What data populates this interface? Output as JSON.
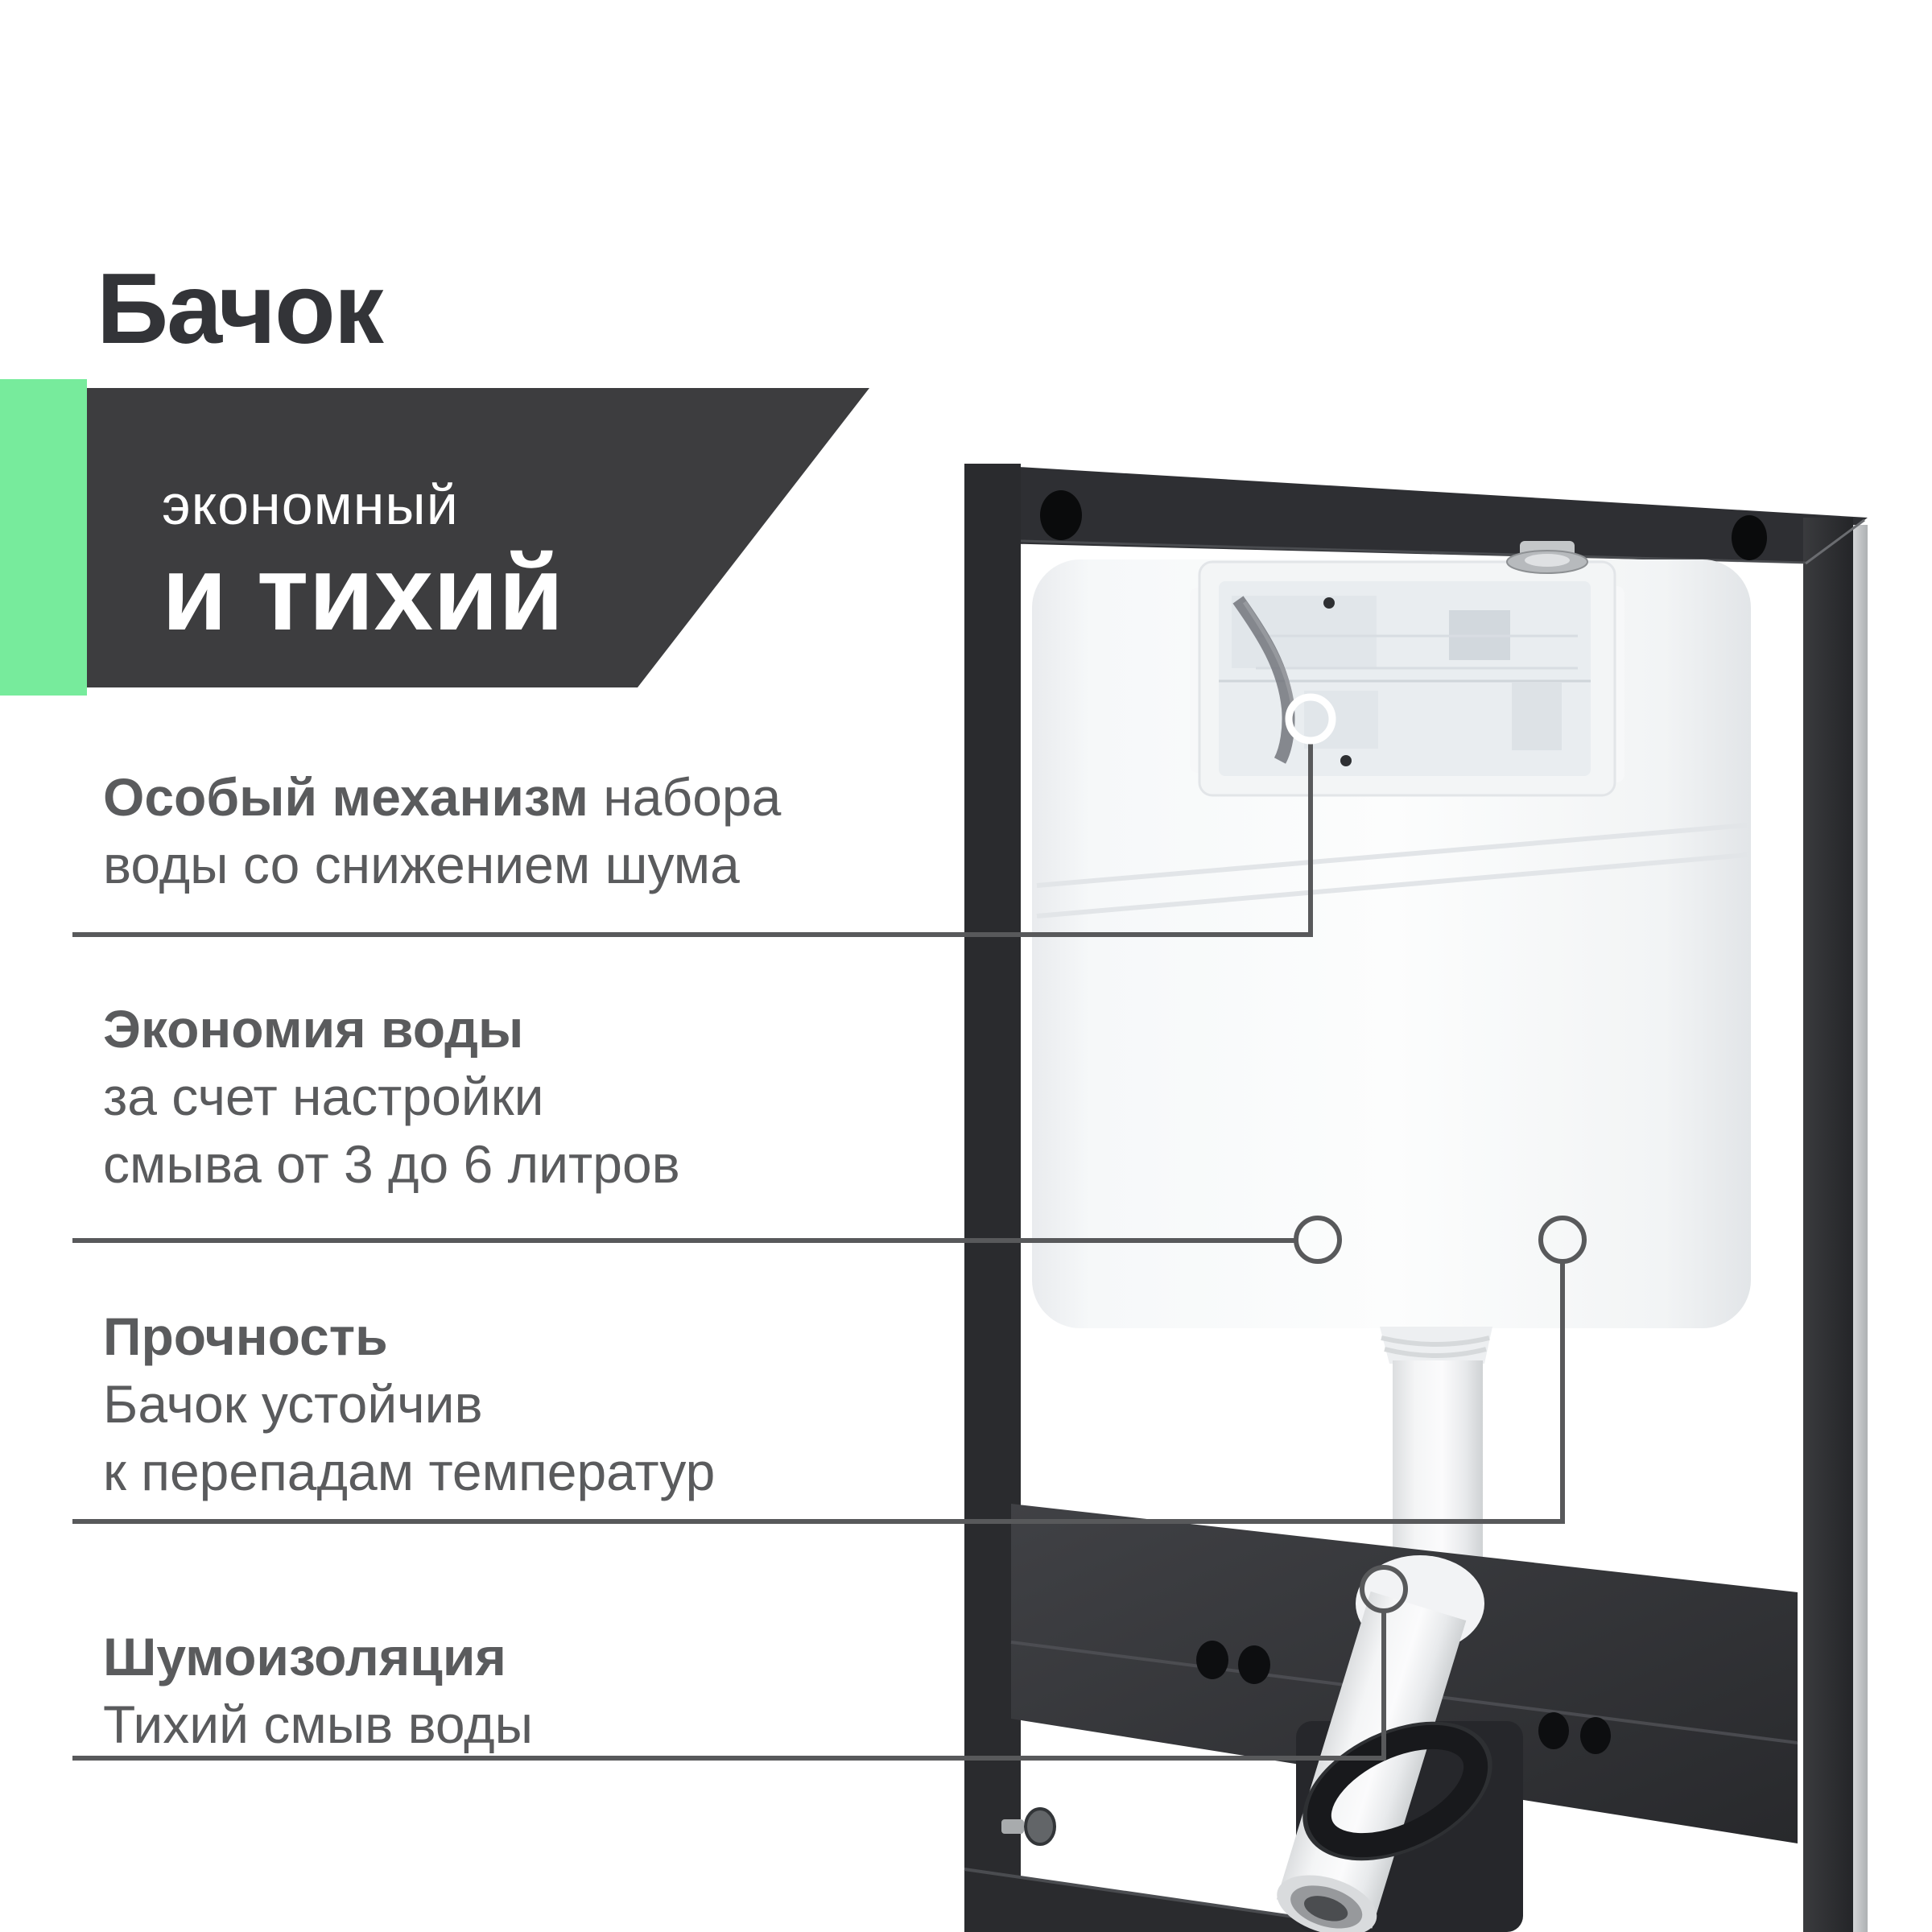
{
  "page": {
    "title": "Бачок",
    "background": "#ffffff"
  },
  "colors": {
    "accent_green": "#77EB9C",
    "banner_dark": "#3D3D3F",
    "heading_dark": "#333438",
    "text_gray": "#5A5B5D",
    "callout_line_gray": "#58595B"
  },
  "banner": {
    "line1": "экономный",
    "line2": "и тихий"
  },
  "features": [
    {
      "bold": "Особый механизм",
      "bold_tail": " набора",
      "lines": [
        "воды со снижением шума"
      ]
    },
    {
      "bold": "Экономия воды",
      "bold_tail": "",
      "lines": [
        "за счет настройки",
        "смыва от 3 до 6 литров"
      ]
    },
    {
      "bold": "Прочность",
      "bold_tail": "",
      "lines": [
        "Бачок устойчив",
        "к перепадам температур"
      ]
    },
    {
      "bold": "Шумоизоляция",
      "bold_tail": "",
      "lines": [
        "Тихий смыв воды"
      ]
    }
  ]
}
